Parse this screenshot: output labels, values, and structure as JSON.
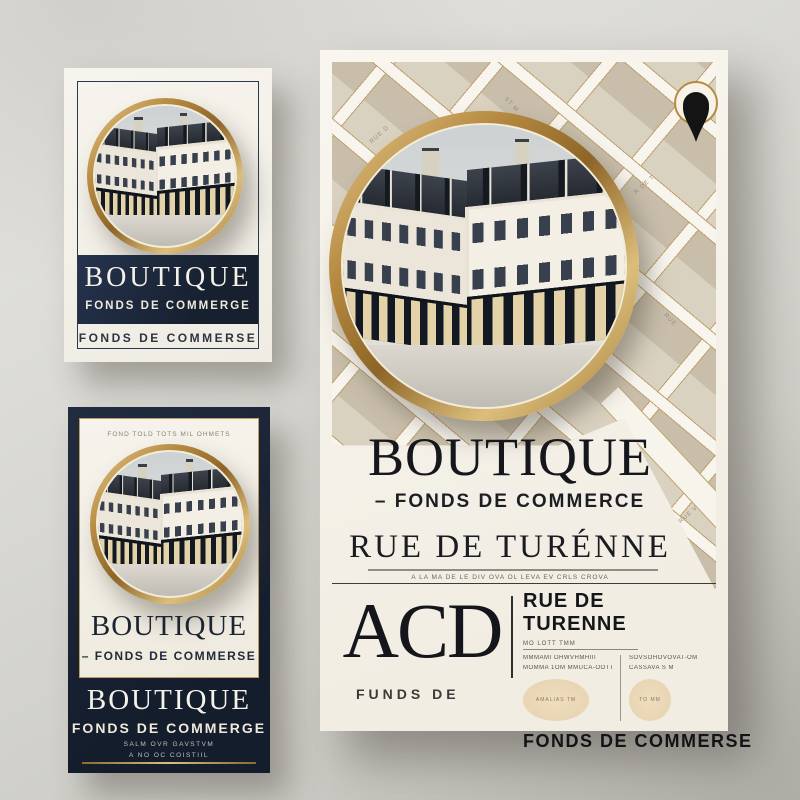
{
  "colors": {
    "gold_accent": "#b68a41",
    "navy": "#1d2738",
    "cream": "#f5f2ea",
    "map_beige": "#d6cdbb",
    "ink": "#15161a"
  },
  "cards": {
    "top_left": {
      "band_title": "BOUTIQUE",
      "band_subtitle": "FONDS DE COMMERGE",
      "caption": "FONDS DE COMMERSE"
    },
    "bottom_left": {
      "header_microtext": "FOND TOLD TOTS MIL OHMETS",
      "title": "BOUTIQUE",
      "subtitle": "– FONDS DE COMMERSE",
      "band_title": "BOUTIQUE",
      "band_subtitle": "FONDS DE COMMERGE",
      "band_microtext_1": "SALM OVR GAVSTVM",
      "band_microtext_2": "A NO OC COISTIIL"
    }
  },
  "poster": {
    "title": "BOUTIQUE",
    "subtitle": "– FONDS DE COMMERCE",
    "street_title": "RUE DE TURÉNNE",
    "street_microtext": "A LA MA DE LE DIV OVA OL LEVA EV CRLS CROVA",
    "brand": "ACD",
    "brand_caption": "FUNDS DE",
    "panel": {
      "header": "RUE DE TURENNE",
      "microlabel": "MO LOTT TMM",
      "left_line_1": "MMMAMI OHWVHMHIII",
      "left_line_2": "MOMMA 1OM MMUCA-OOTT",
      "right_line_1": "SOVSOHOVOVAT-OM",
      "right_line_2": "CASSAVA S M",
      "stamp_left": "AMALIAS TM",
      "stamp_right": "TO MM",
      "footer": "FONDS DE COMMERSE"
    },
    "map_labels": [
      "RUE D",
      "ST M",
      "R DE T",
      "RUE",
      "R. T",
      "RUE V"
    ]
  }
}
